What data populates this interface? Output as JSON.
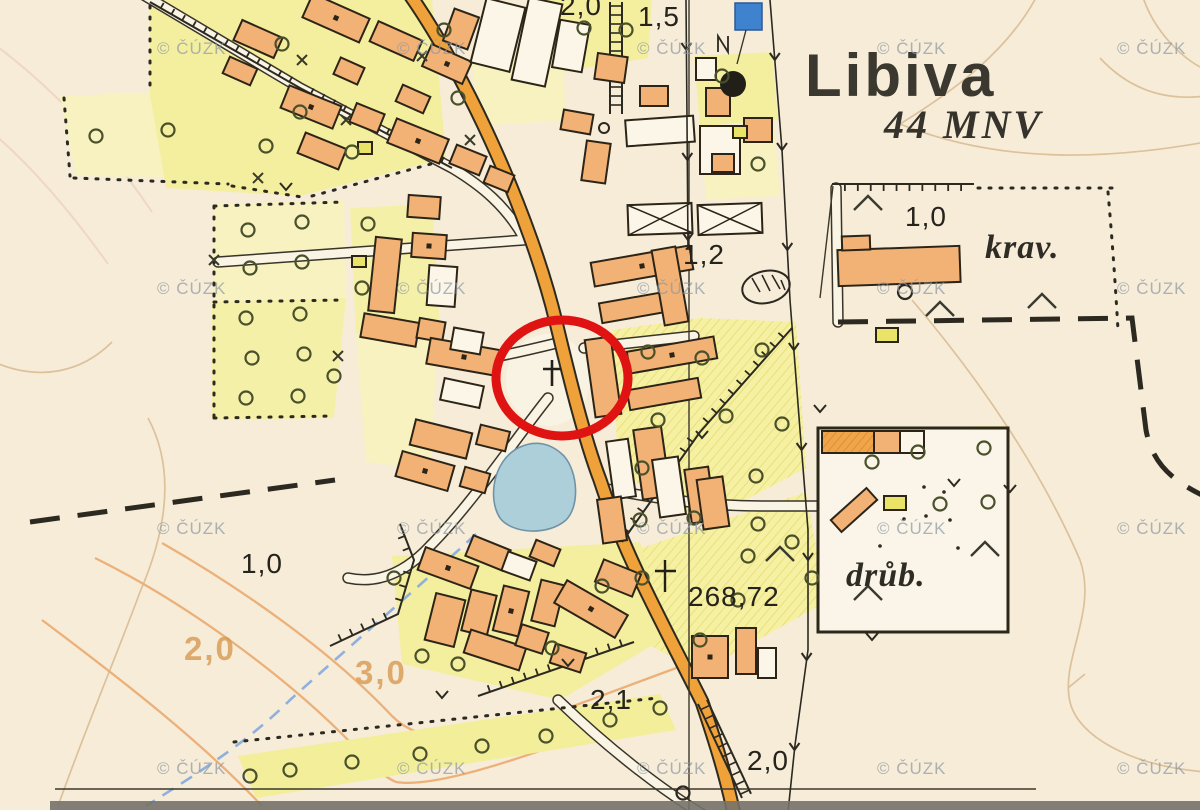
{
  "map": {
    "title": "Libiva",
    "subtitle": "44 MNV",
    "labels": {
      "krav": "krav.",
      "drub": "drůb.",
      "elevation": "268,72",
      "depth_10_ne": "1,0",
      "depth_12": "1,2",
      "depth_20_top": "2,0",
      "depth_15_top": "1,5",
      "depth_21_s": "2,1",
      "depth_20_s": "2,0",
      "depth_10_w": "1,0",
      "contour_20": "2,0",
      "contour_30": "3,0"
    },
    "watermark": "© ČÚZK",
    "colors": {
      "paper": "#f6ecd8",
      "orchard_yellow": "#f4ef9f",
      "building_orange": "#f2b175",
      "road_orange": "#f0a23a",
      "water_blue": "#accfda",
      "stream_blue": "#8fb0de",
      "highlight_red": "#e01313",
      "contour_tan": "#dcc19b",
      "marker_blue": "#3f82cd"
    }
  }
}
